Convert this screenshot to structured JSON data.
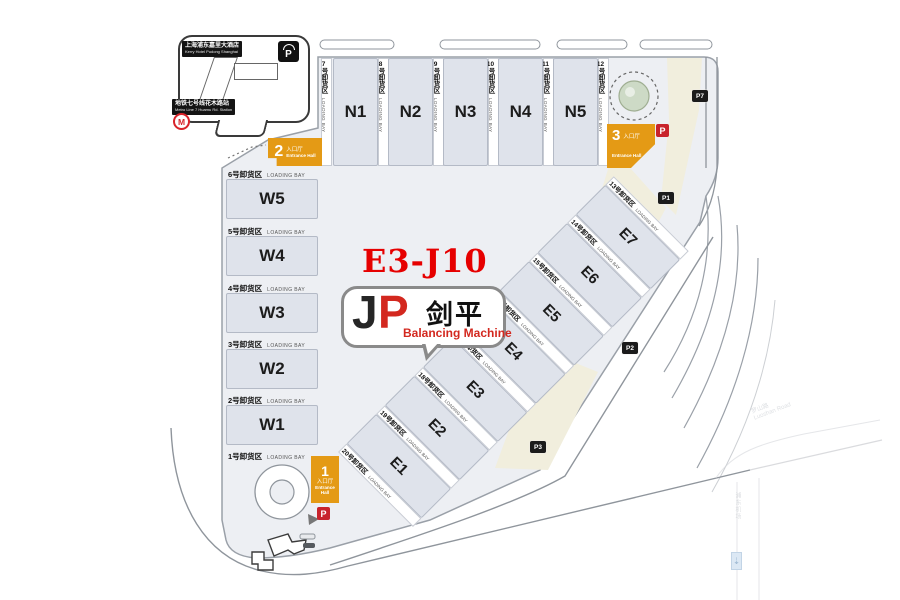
{
  "booth": {
    "code": "E3-J10"
  },
  "exhibitor": {
    "initials_j": "J",
    "initials_p": "P",
    "name_cn": "剑平",
    "tagline": "Balancing Machine"
  },
  "landmarks": {
    "hotel": {
      "cn": "上海浦东嘉里大酒店",
      "en": "Kerry Hotel Pudong Shanghai"
    },
    "metro": {
      "cn": "地铁七号线花木路站",
      "en": "Metro Line 7 Huamu Rd. Station",
      "logo": "M"
    },
    "covered_parking": {
      "symbol": "P"
    }
  },
  "halls": {
    "north": [
      "N1",
      "N2",
      "N3",
      "N4",
      "N5"
    ],
    "west": [
      "W5",
      "W4",
      "W3",
      "W2",
      "W1"
    ],
    "east": [
      "E1",
      "E2",
      "E3",
      "E4",
      "E5",
      "E6",
      "E7"
    ]
  },
  "bays": {
    "en": "LOADING BAY",
    "suffix": "号卸货区",
    "north": [
      "7",
      "8",
      "9",
      "10",
      "11",
      "12"
    ],
    "west": [
      "6",
      "5",
      "4",
      "3",
      "2",
      "1"
    ],
    "east": [
      "20",
      "19",
      "18",
      "17",
      "16",
      "15",
      "14",
      "13"
    ]
  },
  "entrances": {
    "e1": {
      "num": "1",
      "cn": "入口厅",
      "en1": "Entrance",
      "en2": "Hall"
    },
    "e2": {
      "num": "2",
      "cn": "入口厅",
      "en": "Entrance Hall"
    },
    "e3": {
      "num": "3",
      "cn": "入口厅",
      "en": "Entrance Hall"
    }
  },
  "parking": {
    "symbol": "P",
    "p1": "P1",
    "p2": "P2",
    "p3": "P3",
    "p7": "P7"
  },
  "roads": {
    "east_cn": "罗山路",
    "east_en": "Luoshan Road",
    "airport_cn": "浦东机场",
    "airport_en": "Pudong Airport",
    "arrow": "⇣"
  },
  "colors": {
    "accent_orange": "#E49A15",
    "parking_red": "#C8232C",
    "badge_black": "#1B1B1B",
    "hall_fill": "#DFE3EB",
    "beige": "#F1EEDD",
    "booth_red": "#E60000"
  }
}
